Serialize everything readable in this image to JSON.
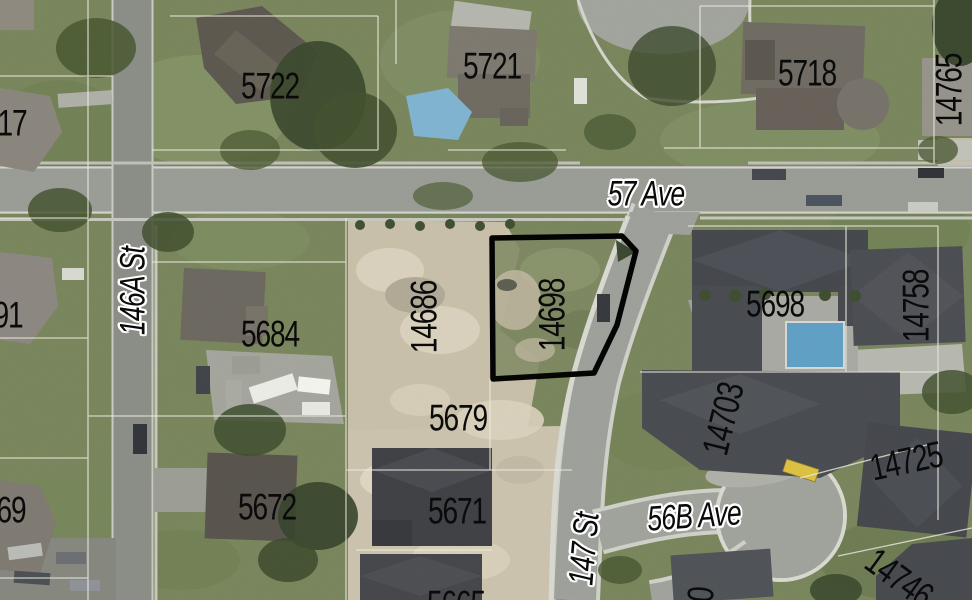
{
  "map": {
    "description": "Aerial orthophoto parcel map with lot numbers and street names; one parcel outlined in bold black",
    "highlighted_parcel": {
      "number": "14698",
      "outline_color": "#000000"
    },
    "street_labels": [
      {
        "text": "57 Ave",
        "x": 646,
        "y": 194,
        "rot": 0
      },
      {
        "text": "146A St",
        "x": 133,
        "y": 291,
        "rot": -90
      },
      {
        "text": "147 St",
        "x": 584,
        "y": 549,
        "rot": -85
      },
      {
        "text": "56B Ave",
        "x": 694,
        "y": 516,
        "rot": -4
      }
    ],
    "parcel_labels": [
      {
        "text": "5722",
        "x": 270,
        "y": 86,
        "rot": 0
      },
      {
        "text": "5721",
        "x": 492,
        "y": 66,
        "rot": 0
      },
      {
        "text": "5718",
        "x": 807,
        "y": 73,
        "rot": 0
      },
      {
        "text": "14765",
        "x": 949,
        "y": 90,
        "rot": -90
      },
      {
        "text": "17",
        "x": 12,
        "y": 123,
        "rot": 0
      },
      {
        "text": "91",
        "x": 8,
        "y": 315,
        "rot": 0
      },
      {
        "text": "69",
        "x": 11,
        "y": 510,
        "rot": 0
      },
      {
        "text": "5684",
        "x": 270,
        "y": 334,
        "rot": 0
      },
      {
        "text": "14686",
        "x": 424,
        "y": 317,
        "rot": -90
      },
      {
        "text": "14698",
        "x": 552,
        "y": 315,
        "rot": -90
      },
      {
        "text": "5698",
        "x": 775,
        "y": 304,
        "rot": 0
      },
      {
        "text": "14758",
        "x": 916,
        "y": 306,
        "rot": -90
      },
      {
        "text": "5679",
        "x": 458,
        "y": 418,
        "rot": 0
      },
      {
        "text": "14703",
        "x": 723,
        "y": 419,
        "rot": -76
      },
      {
        "text": "5672",
        "x": 267,
        "y": 507,
        "rot": 0
      },
      {
        "text": "5671",
        "x": 457,
        "y": 511,
        "rot": 0
      },
      {
        "text": "14725",
        "x": 906,
        "y": 461,
        "rot": -12
      },
      {
        "text": "14746",
        "x": 899,
        "y": 578,
        "rot": 36
      },
      {
        "text": "5665",
        "x": 456,
        "y": 604,
        "rot": 0
      },
      {
        "text": "80",
        "x": 700,
        "y": 602,
        "rot": -85
      }
    ],
    "palette": {
      "parcel_outline": "#000000",
      "label_text": "#0a0a0a",
      "street_label_halo": "#ffffff",
      "road": "#9a9c96",
      "grass": "#78855b",
      "dirt": "#c8bfa9",
      "dark_roof": "#43464b",
      "pool": "#6fa9cb",
      "school_bus": "#ddc041"
    }
  }
}
